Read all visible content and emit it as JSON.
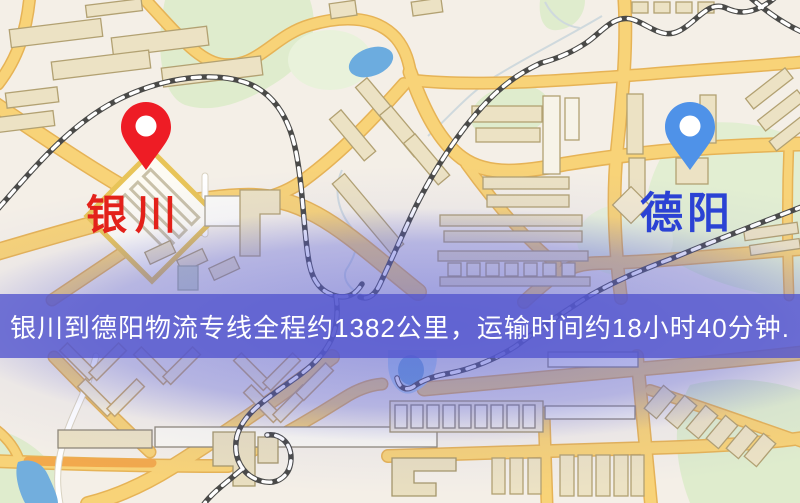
{
  "map": {
    "origin": {
      "label": "银川",
      "pin_color": "#ee1c25",
      "label_color": "#e3211a"
    },
    "destination": {
      "label": "德阳",
      "pin_color": "#4f92e8",
      "label_color": "#2b42d4"
    }
  },
  "banner": {
    "text": "银川到德阳物流专线全程约1382公里，运输时间约18小时40分钟.",
    "background_color": "#5456ce",
    "text_color": "#ffffff",
    "route": {
      "origin": "银川",
      "destination": "德阳",
      "distance": "约1382公里",
      "duration": "约18小时40分钟"
    }
  },
  "map_colors": {
    "background": "#f4efe7",
    "road_fill": "#f8d378",
    "road_casing": "#e6b356",
    "orange_road": "#f2a94d",
    "water": "#6fb0e0",
    "park": "#dfeccd",
    "building": "#ece2c4",
    "railway": "#4a4a48"
  }
}
